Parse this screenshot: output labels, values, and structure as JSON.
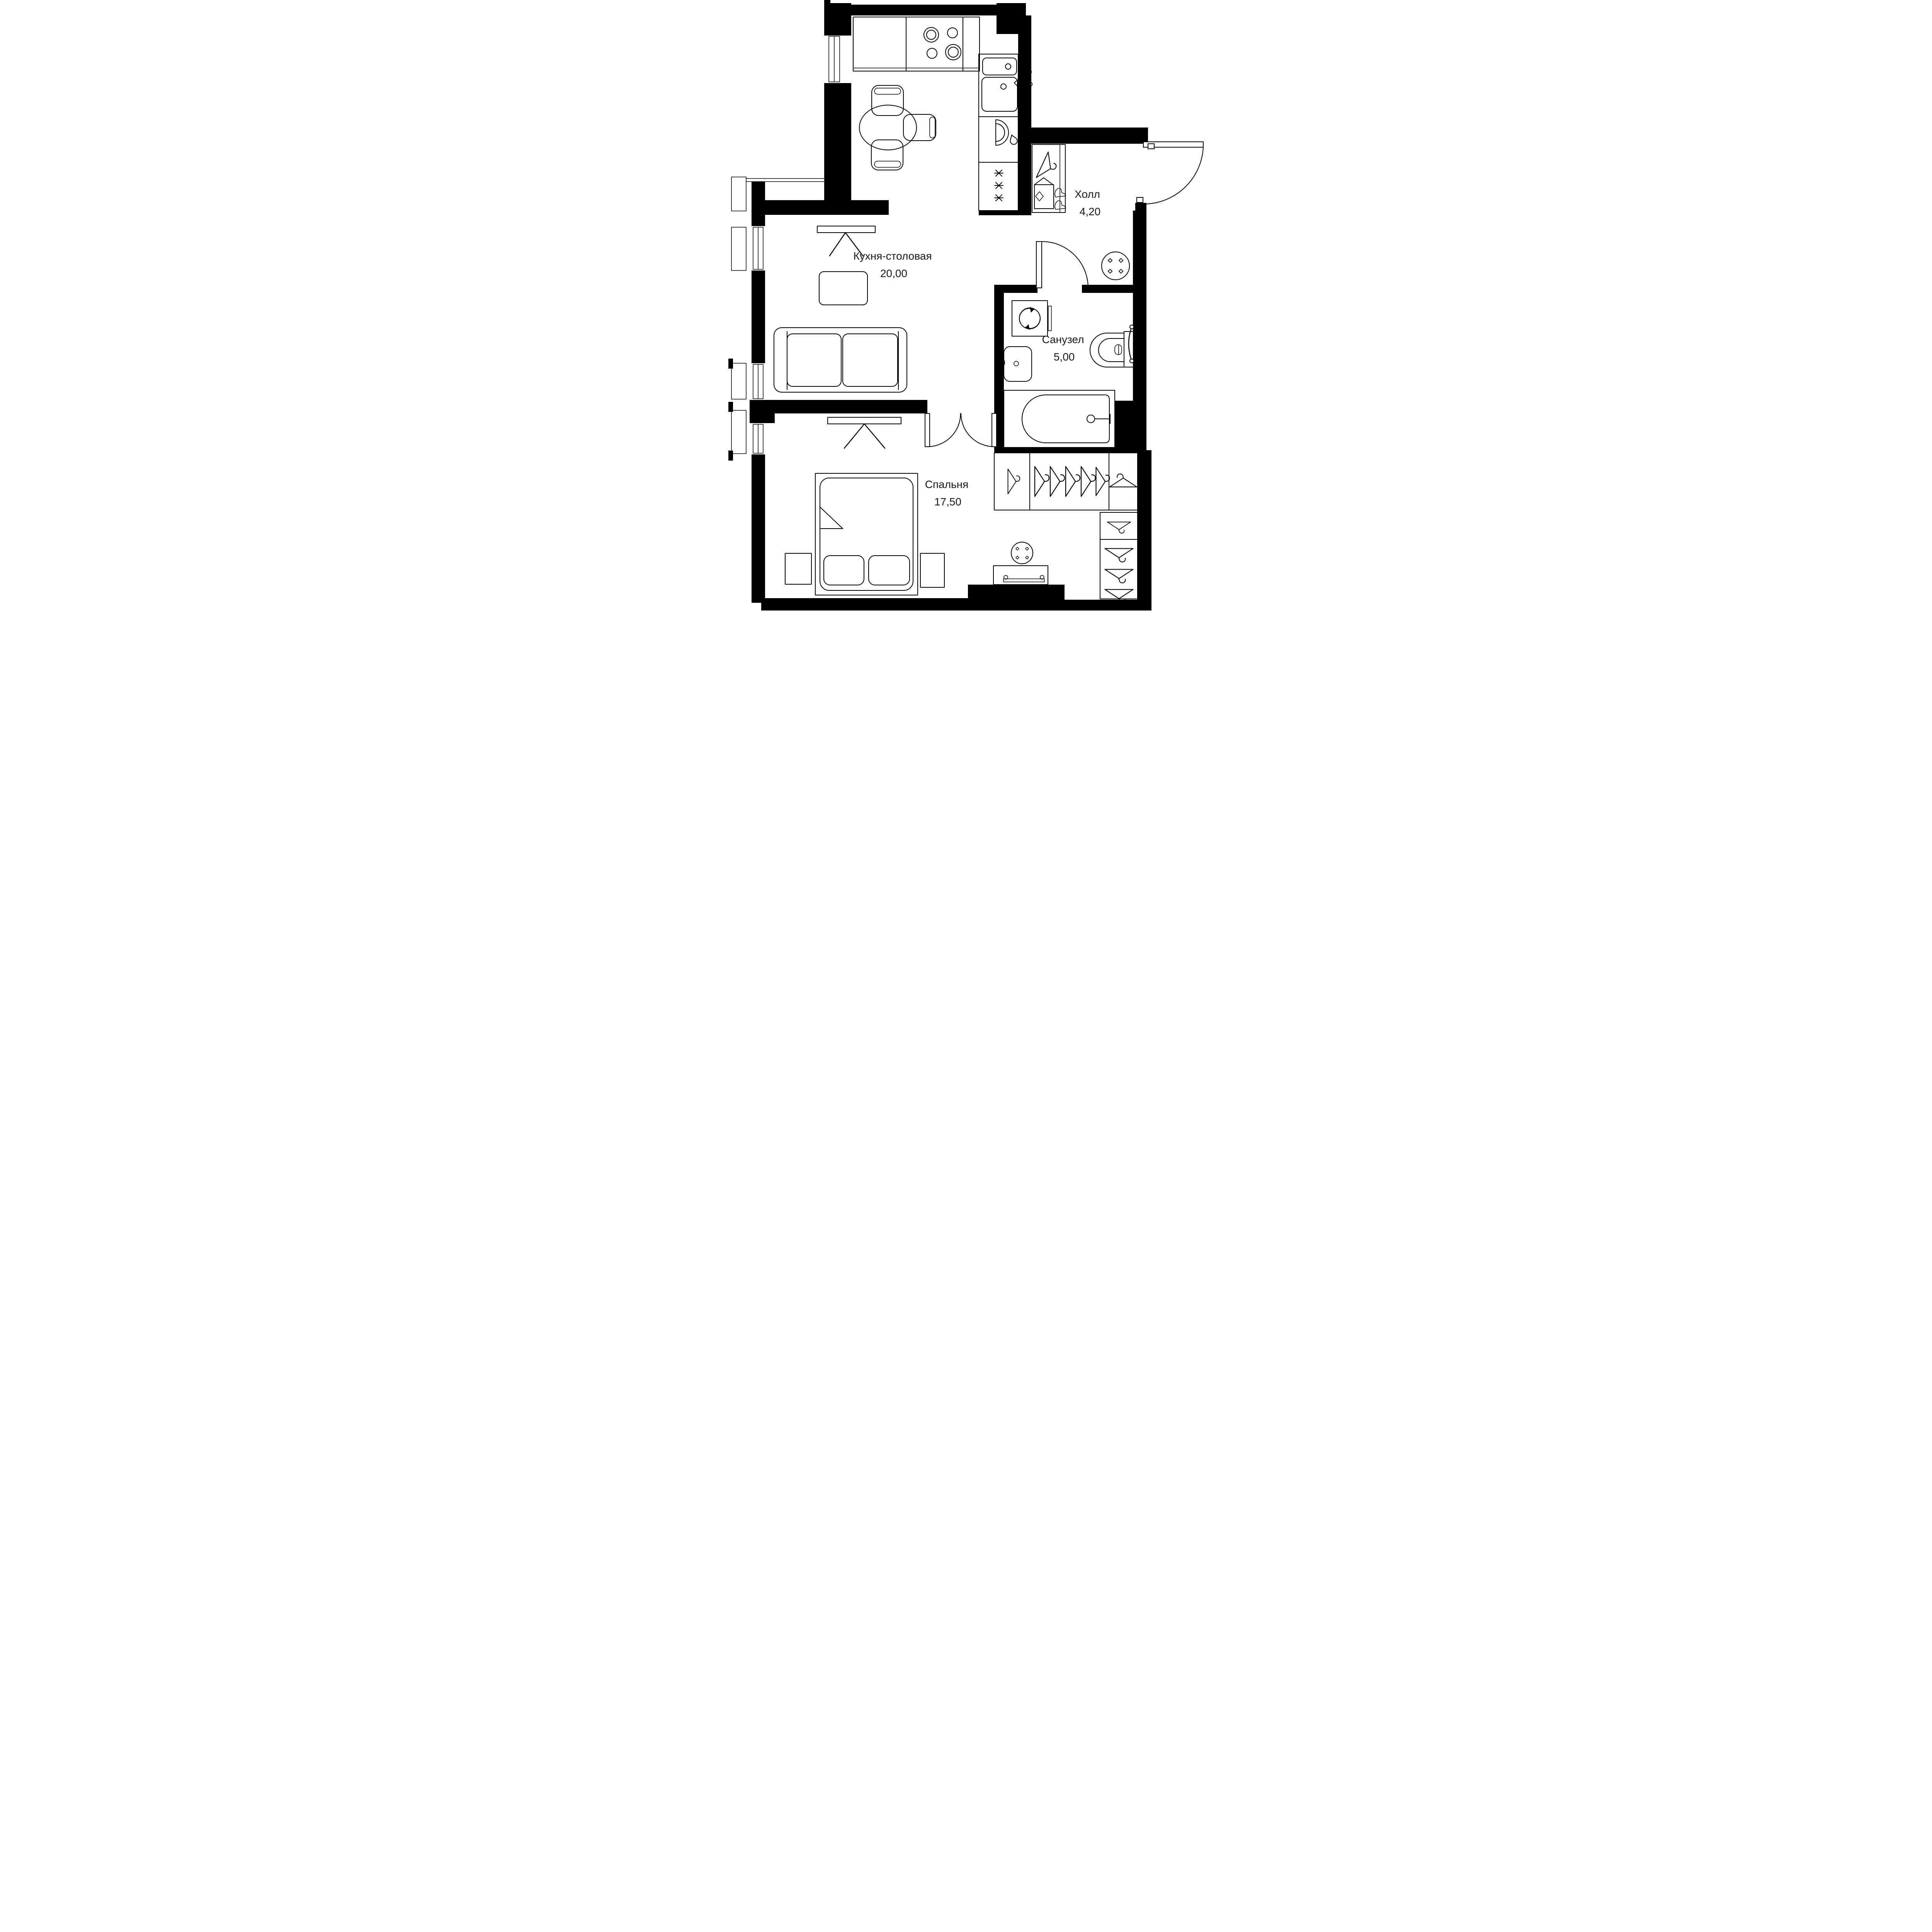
{
  "floorplan": {
    "rooms": [
      {
        "id": "kitchen_dining",
        "name": "Кухня-столовая",
        "area": "20,00"
      },
      {
        "id": "hall",
        "name": "Холл",
        "area": "4,20"
      },
      {
        "id": "bathroom",
        "name": "Санузел",
        "area": "5,00"
      },
      {
        "id": "bedroom",
        "name": "Спальня",
        "area": "17,50"
      }
    ],
    "colors": {
      "walls": "#000000",
      "lines": "#000000",
      "text": "#1a1a1a",
      "background": "#ffffff"
    },
    "fixtures": {
      "kitchen_dining": [
        "cooktop-icon",
        "kitchen-sink-icon",
        "dishwasher-icon",
        "fridge-icon",
        "dining-table",
        "dining-chairs",
        "tv-icon",
        "coffee-table",
        "sofa"
      ],
      "hall": [
        "entrance-door",
        "closet-hanger-icon",
        "shoe-box-icon",
        "boots-icon",
        "pouf"
      ],
      "bathroom": [
        "washing-machine-icon",
        "bathroom-sink-icon",
        "toilet-icon",
        "bathtub-icon",
        "towel-rail-icon",
        "door-swing"
      ],
      "bedroom": [
        "double-bed",
        "pillows",
        "nightstands",
        "tv-icon",
        "pouf",
        "console-drawer",
        "wardrobe-hangers"
      ],
      "windows": [
        "window",
        "window",
        "window",
        "window"
      ]
    }
  }
}
